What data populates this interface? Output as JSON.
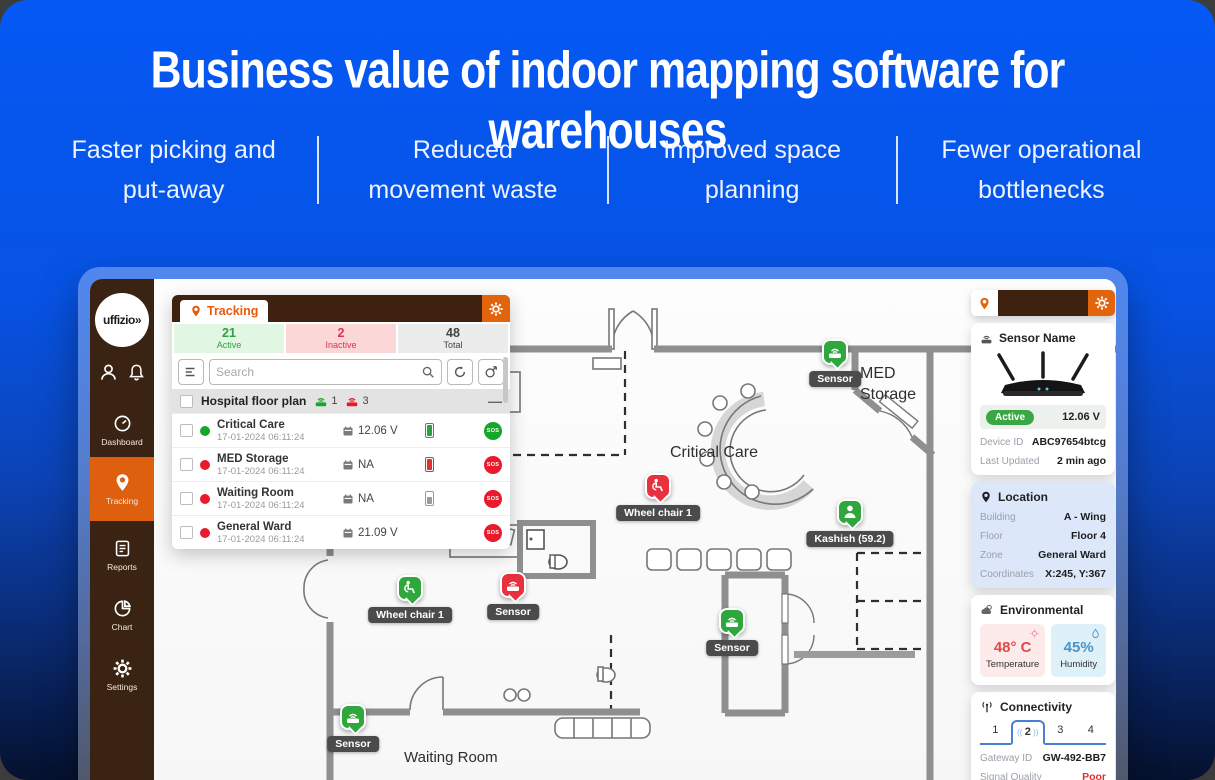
{
  "header": {
    "title": "Business value of indoor mapping software for warehouses",
    "benefits": [
      {
        "line1": "Faster picking and",
        "line2": "put-away"
      },
      {
        "line1": "Reduced",
        "line2": "movement waste"
      },
      {
        "line1": "Improved space",
        "line2": "planning"
      },
      {
        "line1": "Fewer operational",
        "line2": "bottlenecks"
      }
    ]
  },
  "app": {
    "sidebar": {
      "logo": "uffizio»",
      "items": [
        {
          "label": "Dashboard"
        },
        {
          "label": "Tracking"
        },
        {
          "label": "Reports"
        },
        {
          "label": "Chart"
        },
        {
          "label": "Settings"
        }
      ]
    },
    "tracking_panel": {
      "tab": "Tracking",
      "stats": {
        "active_count": "21",
        "active_label": "Active",
        "inactive_count": "2",
        "inactive_label": "Inactive",
        "total_count": "48",
        "total_label": "Total"
      },
      "search_placeholder": "Search",
      "group": {
        "name": "Hospital floor plan",
        "online_count": "1",
        "offline_count": "3"
      },
      "rows": [
        {
          "name": "Critical Care",
          "time": "17-01-2024 06:11:24",
          "value": "12.06 V",
          "sos": "SOS",
          "status": "green",
          "battery": "green"
        },
        {
          "name": "MED Storage",
          "time": "17-01-2024 06:11:24",
          "value": "NA",
          "sos": "SOS",
          "status": "red",
          "battery": "red"
        },
        {
          "name": "Waiting Room",
          "time": "17-01-2024 06:11:24",
          "value": "NA",
          "sos": "SOS",
          "status": "red",
          "battery": "gray"
        },
        {
          "name": "General Ward",
          "time": "17-01-2024 06:11:24",
          "value": "21.09 V",
          "sos": "SOS",
          "status": "red",
          "battery": "none"
        }
      ]
    },
    "map": {
      "rooms": {
        "med_line1": "MED",
        "med_line2": "Storage",
        "critical_care": "Critical Care",
        "waiting_room": "Waiting Room"
      },
      "markers": [
        {
          "type": "sensor",
          "color": "green",
          "label": "Sensor"
        },
        {
          "type": "wheelchair",
          "color": "red",
          "label": "Wheel chair 1"
        },
        {
          "type": "person",
          "color": "green",
          "label": "Kashish (59.2)"
        },
        {
          "type": "wheelchair",
          "color": "green",
          "label": "Wheel chair 1"
        },
        {
          "type": "sensor",
          "color": "red",
          "label": "Sensor"
        },
        {
          "type": "sensor",
          "color": "green",
          "label": "Sensor"
        },
        {
          "type": "sensor",
          "color": "green",
          "label": "Sensor"
        }
      ]
    },
    "detail_panel": {
      "sensor_card": {
        "title": "Sensor Name",
        "status": "Active",
        "voltage": "12.06 V",
        "device_id_label": "Device ID",
        "device_id": "ABC97654btcg",
        "last_updated_label": "Last Updated",
        "last_updated": "2 min ago"
      },
      "location_card": {
        "title": "Location",
        "rows": [
          {
            "label": "Building",
            "value": "A - Wing"
          },
          {
            "label": "Floor",
            "value": "Floor 4"
          },
          {
            "label": "Zone",
            "value": "General Ward"
          },
          {
            "label": "Coordinates",
            "value": "X:245, Y:367"
          }
        ]
      },
      "environmental_card": {
        "title": "Environmental",
        "temperature_value": "48° C",
        "temperature_label": "Temperature",
        "humidity_value": "45%",
        "humidity_label": "Humidity"
      },
      "connectivity_card": {
        "title": "Connectivity",
        "tabs": [
          "1",
          "2",
          "3",
          "4"
        ],
        "selected_tab": "2",
        "gateway_label": "Gateway ID",
        "gateway_value": "GW-492-BB7",
        "signal_label": "Signal Quality",
        "signal_value": "Poor",
        "rssi_label": "RSSI",
        "rssi_value": "-91.000 db"
      }
    }
  },
  "colors": {
    "accent_orange": "#E2650E",
    "sidebar_brown": "#3A2313",
    "active_green": "#2DA044",
    "inactive_red": "#DC3545",
    "marker_green": "#2FA73C",
    "marker_red": "#E8313F",
    "poor_red": "#E03131",
    "humidity_blue": "#4A93C8",
    "background_blue": "#0558F4"
  }
}
